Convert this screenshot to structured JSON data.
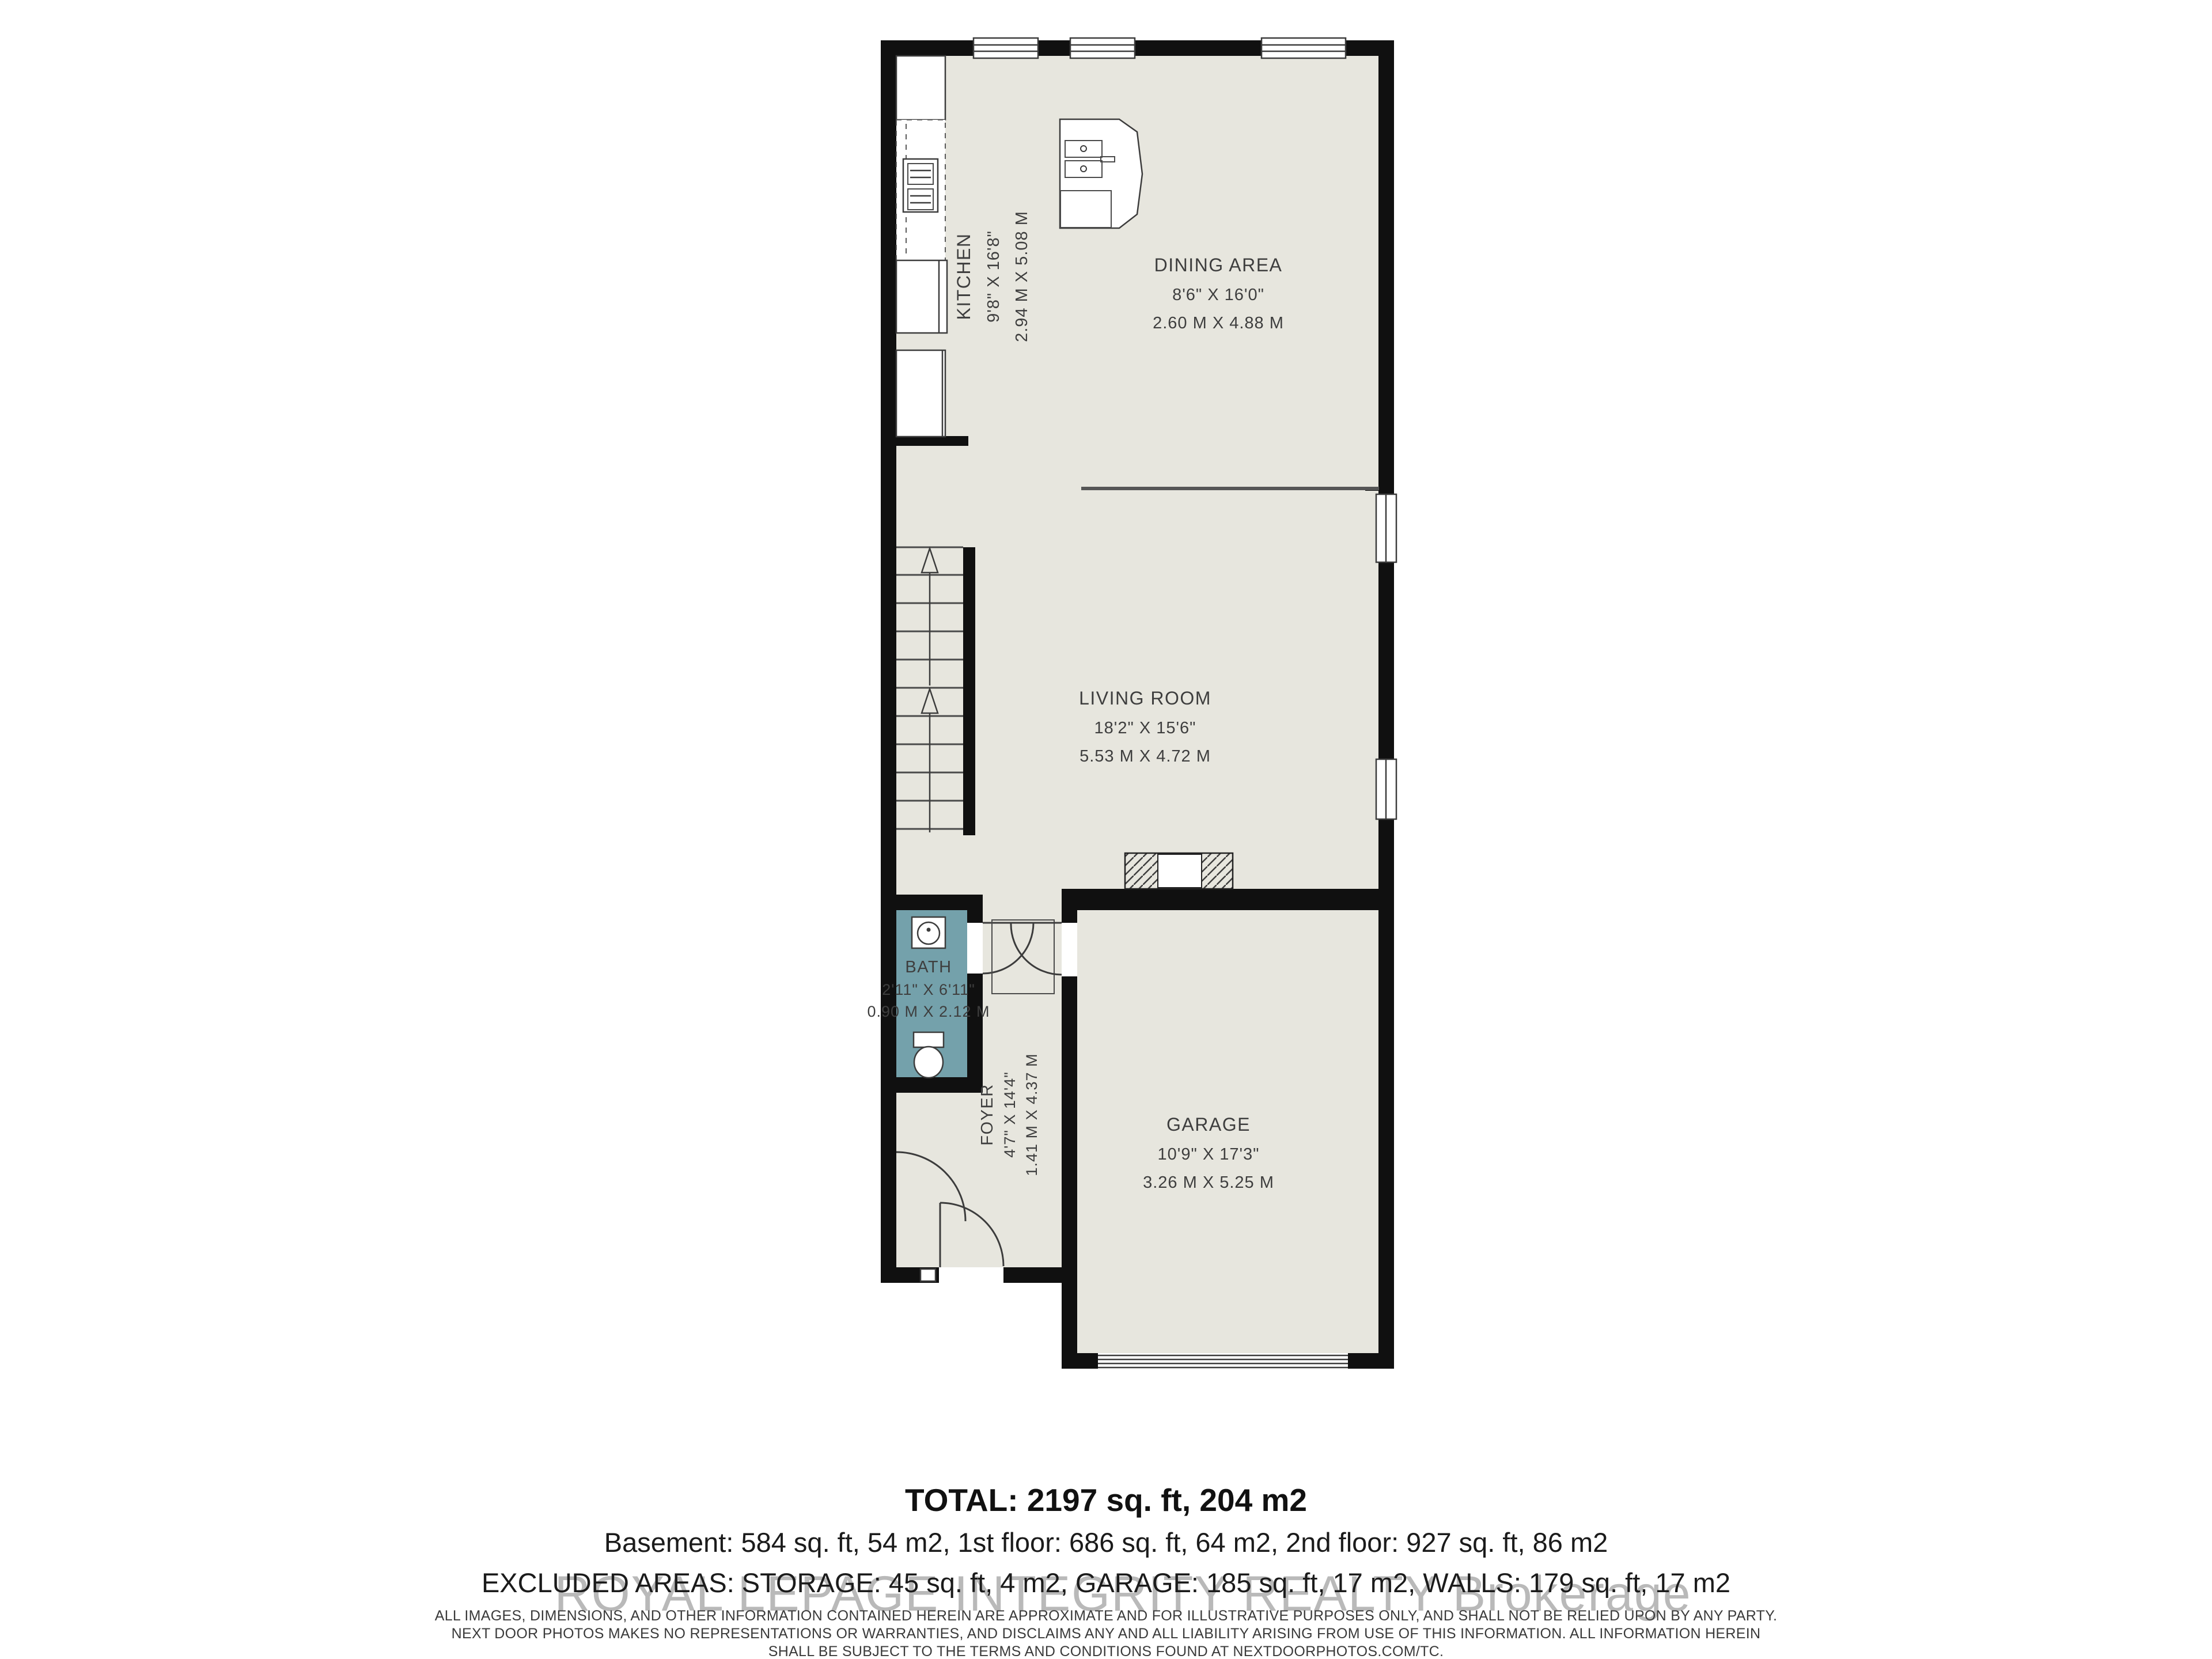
{
  "floorplan": {
    "rooms": {
      "kitchen": {
        "name": "KITCHEN",
        "ft": "9'8\" X 16'8\"",
        "m": "2.94 M X 5.08 M"
      },
      "dining": {
        "name": "DINING AREA",
        "ft": "8'6\" X 16'0\"",
        "m": "2.60 M X 4.88 M"
      },
      "living": {
        "name": "LIVING ROOM",
        "ft": "18'2\" X 15'6\"",
        "m": "5.53 M X 4.72 M"
      },
      "bath": {
        "name": "BATH",
        "ft": "2'11\" X 6'11\"",
        "m": "0.90 M X 2.12 M"
      },
      "foyer": {
        "name": "FOYER",
        "ft": "4'7\" X 14'4\"",
        "m": "1.41 M X 4.37 M"
      },
      "garage": {
        "name": "GARAGE",
        "ft": "10'9\" X 17'3\"",
        "m": "3.26 M X 5.25 M"
      }
    },
    "colors": {
      "wall": "#101010",
      "floor": "#e7e6de",
      "bath_floor": "#74a1ab",
      "line": "#3c3c3c"
    },
    "icons": [
      "stairs-up-arrow",
      "kitchen-island-sink",
      "stove",
      "toilet",
      "bath-sink",
      "garage-door",
      "entry-steps-hatch"
    ]
  },
  "watermark": "ROYAL LEPAGE INTEGRITY REALTY Brokerage",
  "summary": {
    "total": "TOTAL: 2197 sq. ft, 204 m2",
    "floors": "Basement: 584 sq. ft, 54 m2, 1st floor: 686 sq. ft, 64 m2, 2nd floor: 927 sq. ft, 86 m2",
    "excluded": "EXCLUDED AREAS: STORAGE: 45 sq. ft, 4 m2, GARAGE: 185 sq. ft, 17 m2, WALLS: 179 sq. ft, 17 m2"
  },
  "disclaimer": {
    "line1": "ALL IMAGES, DIMENSIONS, AND OTHER INFORMATION CONTAINED HEREIN ARE APPROXIMATE AND FOR ILLUSTRATIVE PURPOSES ONLY, AND SHALL NOT BE RELIED UPON BY ANY PARTY.",
    "line2": "NEXT DOOR PHOTOS MAKES NO REPRESENTATIONS OR WARRANTIES, AND DISCLAIMS ANY AND ALL LIABILITY ARISING FROM USE OF THIS INFORMATION. ALL INFORMATION HEREIN",
    "line3": "SHALL BE SUBJECT TO THE TERMS AND CONDITIONS FOUND AT NEXTDOORPHOTOS.COM/TC."
  }
}
